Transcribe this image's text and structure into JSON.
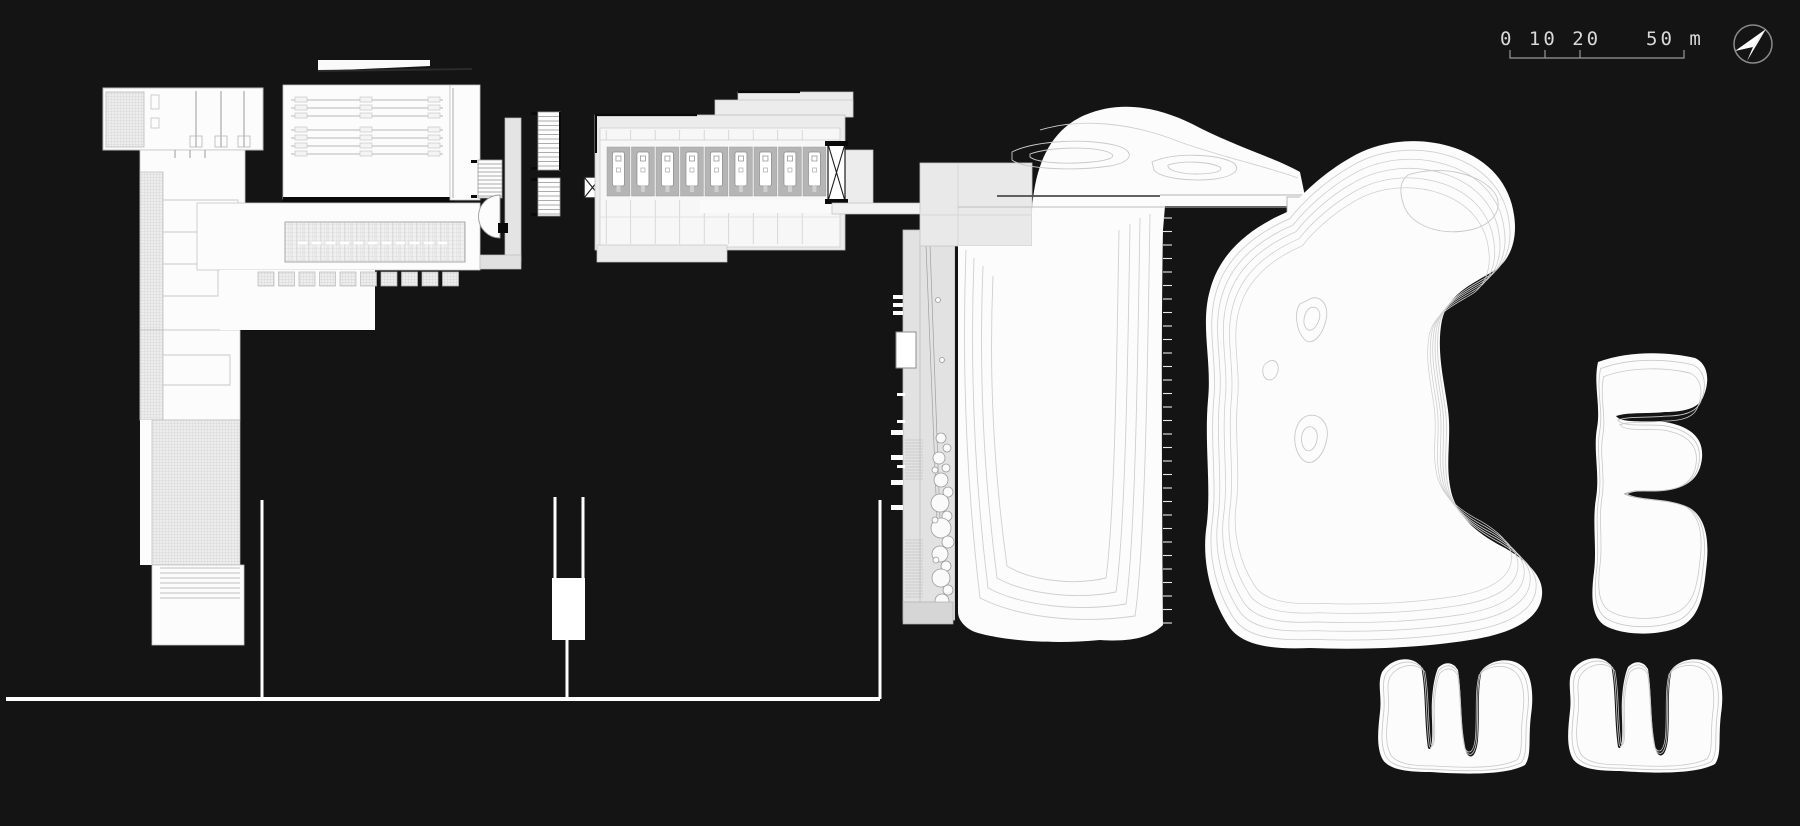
{
  "title": "architectural-site-plan",
  "canvas": {
    "width": 1800,
    "height": 826,
    "background": "#141414"
  },
  "scale_bar": {
    "label_left": "0 10 20",
    "label_right": "50 m",
    "unit": "m",
    "ticks_m": [
      0,
      10,
      20,
      50
    ],
    "text_color": "#d9d9d9",
    "line_color": "#9a9a9a"
  },
  "compass": {
    "icon": "north-arrow-icon",
    "direction": "NE"
  },
  "palette": {
    "background": "#141414",
    "white_fill": "#fcfcfc",
    "light_gray_fill": "#ececec",
    "mid_gray_fill": "#b5b5b5",
    "contour_line": "#cfcfcf",
    "dark_line": "#0a0a0a"
  },
  "hotel_block": {
    "room_modules": 9
  },
  "pond_islands": 5
}
